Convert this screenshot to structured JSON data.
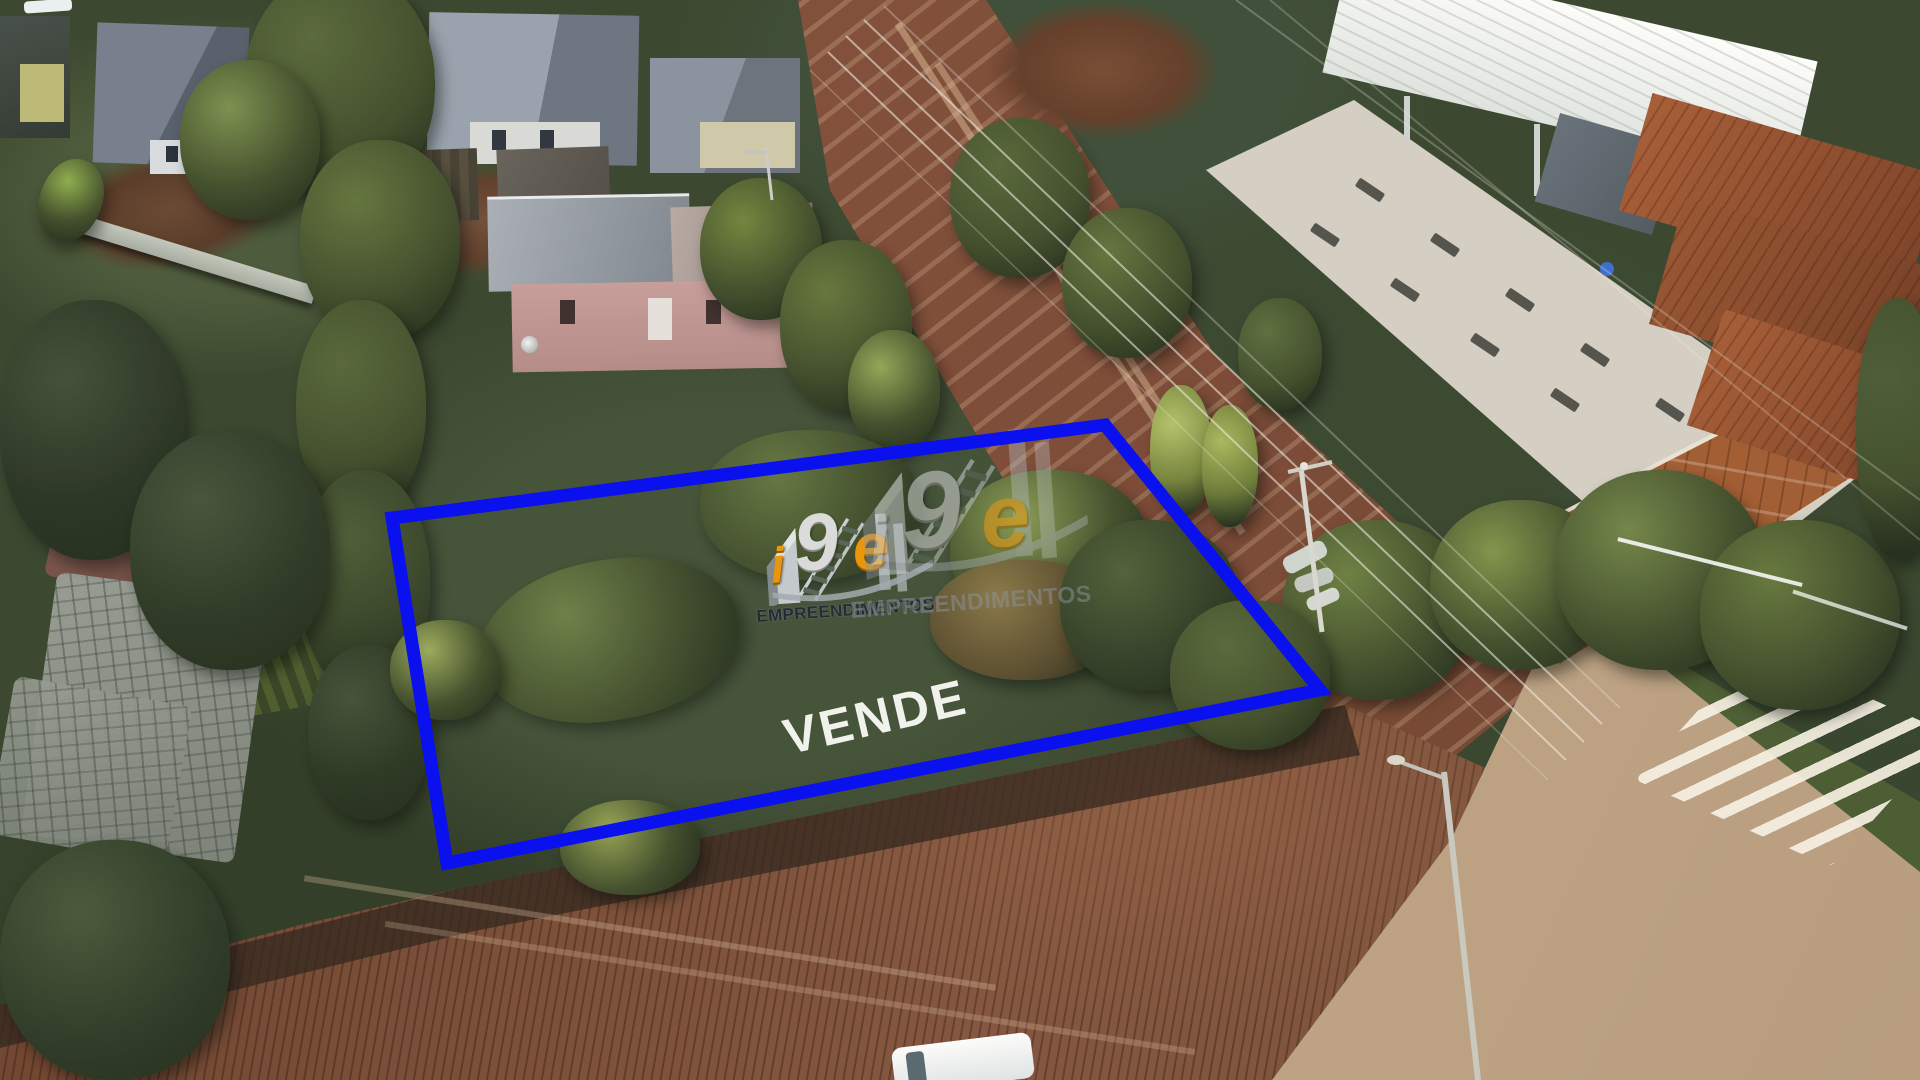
{
  "overlay": {
    "vende_label": "VENDE",
    "lot_outline": {
      "color": "#0a10ee",
      "points": "392,518 1105,425 1320,690 447,863"
    },
    "watermark": {
      "brand": "i9e",
      "letter_i": "i",
      "letter_9": "9",
      "letter_e": "e",
      "subtitle": "EMPREENDIMENTOS",
      "orange_color": "#f39a0b",
      "silver_color": "#dcdcdc",
      "instances_visible": 2
    }
  }
}
